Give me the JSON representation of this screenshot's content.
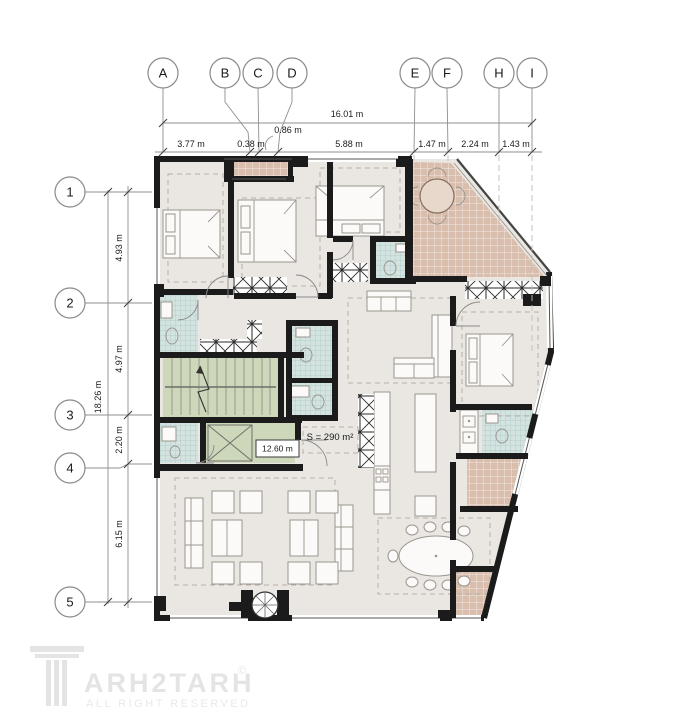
{
  "grid": {
    "columns": [
      "A",
      "B",
      "C",
      "D",
      "E",
      "F",
      "H",
      "I"
    ],
    "rows": [
      "1",
      "2",
      "3",
      "4",
      "5"
    ]
  },
  "dimensions": {
    "top_total": "16.01 m",
    "top_segments": [
      "3.77 m",
      "0.38 m",
      "0.86 m",
      "5.88 m",
      "1.47 m",
      "2.24 m",
      "1.43 m"
    ],
    "left_total": "18.26 m",
    "left_segments": [
      "4.93 m",
      "4.97 m",
      "2.20 m",
      "6.15 m"
    ]
  },
  "labels": {
    "area": "S = 290 m²",
    "stair_room": "12.60 m"
  },
  "watermark": {
    "brand": "ARH2TARH",
    "copyright": "©",
    "tagline": "ALL RIGHT RESERVED"
  },
  "colors": {
    "wall": "#1b1b1b",
    "floor": "#eae7e2",
    "terrace": "#d9beae",
    "tile": "#d2e3e0",
    "stairs": "#cdd7ba",
    "accent_line": "#8f8f8f"
  }
}
